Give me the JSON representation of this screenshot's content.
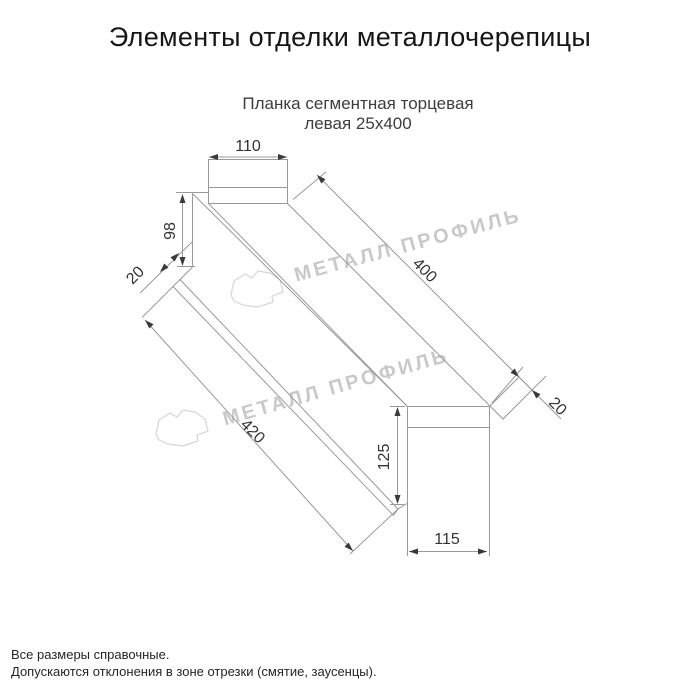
{
  "header": {
    "title": "Элементы отделки металлочерепицы"
  },
  "drawing": {
    "subtitle_line1": "Планка сегментная торцевая",
    "subtitle_line2": "левая 25х400",
    "dimensions": {
      "top_width": "110",
      "left_height": "98",
      "left_fold": "20",
      "top_length": "400",
      "bottom_length": "420",
      "right_fold": "20",
      "end_height": "125",
      "end_width": "115"
    },
    "watermark": {
      "text": "МЕТАЛЛ ПРОФИЛЬ",
      "color": "#c9c9c9"
    }
  },
  "footer": {
    "note1": "Все размеры справочные.",
    "note2": "Допускаются отклонения в зоне отрезки (смятие, заусенцы)."
  },
  "colors": {
    "background": "#ffffff",
    "outline": "#999999",
    "dimension_text": "#333333",
    "title_text": "#161616"
  }
}
